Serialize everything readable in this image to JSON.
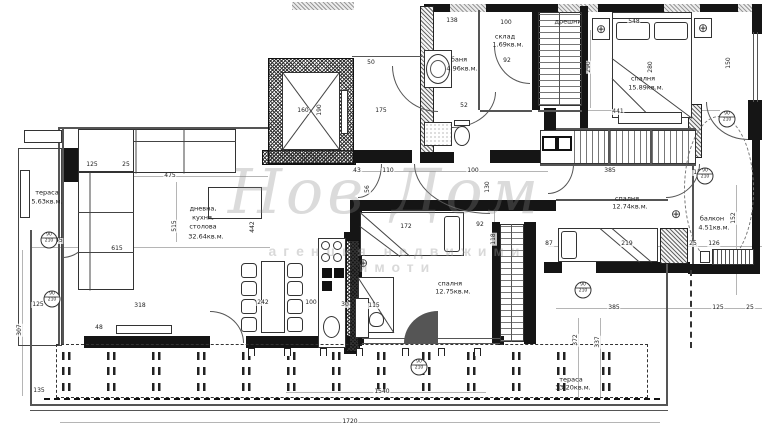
{
  "watermark": {
    "script": "Нов Дом",
    "agency": "агенция недвижими имоти"
  },
  "rooms": {
    "terrace_left": {
      "name": "тераса",
      "area": "5.63кв.м."
    },
    "living": {
      "l1": "дневна,",
      "l2": "кухня,",
      "l3": "столова",
      "area": "32.64кв.м."
    },
    "bath": {
      "name": "баня",
      "area": "4.96кв.м."
    },
    "storage": {
      "name": "склад",
      "area": "1.69кв.м."
    },
    "closet": {
      "name": "дрешник"
    },
    "bedroom_top": {
      "name": "спалня",
      "area": "15.89кв.м."
    },
    "bedroom_right": {
      "name": "спалня",
      "area": "12.74кв.м."
    },
    "bedroom_mid": {
      "name": "спалня",
      "area": "12.75кв.м."
    },
    "balcony": {
      "name": "балкон",
      "area": "4.51кв.м."
    },
    "terrace_bottom": {
      "name": "тераса",
      "area": "33.20кв.м."
    }
  },
  "dims": [
    "125",
    "25",
    "475",
    "515",
    "145",
    "615",
    "442",
    "242",
    "100",
    "30",
    "318",
    "125",
    "307",
    "48",
    "135",
    "160",
    "190",
    "175",
    "43",
    "110",
    "100",
    "172",
    "92",
    "118",
    "56",
    "130",
    "138",
    "100",
    "92",
    "52",
    "548",
    "290",
    "280",
    "441",
    "150",
    "385",
    "150",
    "152",
    "219",
    "25",
    "126",
    "87",
    "385",
    "125",
    "25",
    "372",
    "337",
    "1540",
    "1720",
    "50",
    "115"
  ],
  "markers": [
    {
      "w": "90",
      "h": "210"
    },
    {
      "w": "90",
      "h": "210"
    },
    {
      "w": "90",
      "h": "210"
    },
    {
      "w": "90",
      "h": "210"
    },
    {
      "w": "90",
      "h": "210"
    },
    {
      "w": "90",
      "h": "210"
    }
  ],
  "colors": {
    "wall": "#151515",
    "line": "#555555",
    "watermark": "#878787"
  }
}
